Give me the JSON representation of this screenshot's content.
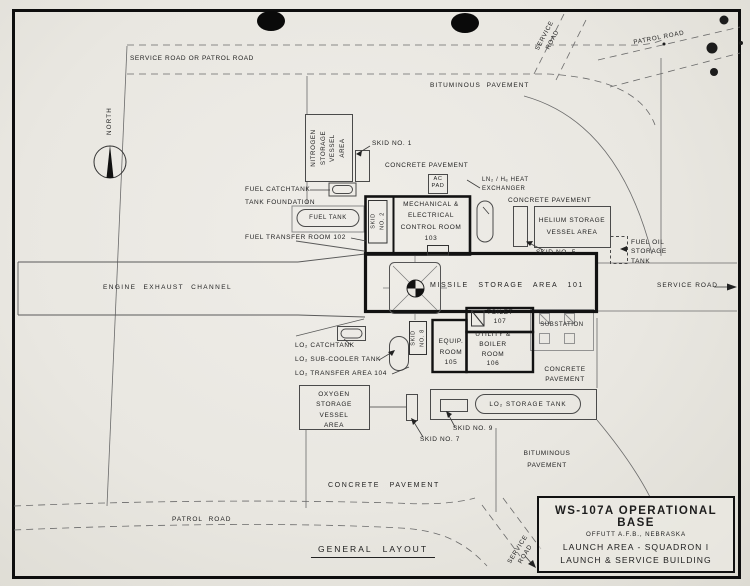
{
  "colors": {
    "paper": "#eae8e2",
    "ink": "#1d1d1d",
    "thin_line": "#5a5a5a",
    "wall": "#121212"
  },
  "title_block": {
    "l1": "WS-107A OPERATIONAL BASE",
    "l2": "OFFUTT A.F.B., NEBRASKA",
    "l3": "LAUNCH AREA - SQUADRON I",
    "l4": "LAUNCH & SERVICE BUILDING"
  },
  "caption": "GENERAL LAYOUT",
  "compass": "NORTH",
  "roads": {
    "top": "SERVICE ROAD OR PATROL ROAD",
    "service_tr": "SERVICE\nROAD",
    "patrol_tr": "PATROL ROAD",
    "service_east": "SERVICE ROAD",
    "patrol_bottom": "PATROL ROAD",
    "service_br": "SERVICE\nROAD"
  },
  "pavement": {
    "bituminous_top": "BITUMINOUS PAVEMENT",
    "bituminous_se": "BITUMINOUS\nPAVEMENT",
    "concrete_north": "CONCRETE PAVEMENT",
    "concrete_ne": "CONCRETE PAVEMENT",
    "concrete_se": "CONCRETE\nPAVEMENT",
    "concrete_south": "CONCRETE PAVEMENT"
  },
  "rooms": {
    "mech": "MECHANICAL &\nELECTRICAL\nCONTROL ROOM\n103",
    "missile": "MISSILE STORAGE AREA 101",
    "fuel_transfer": "FUEL TRANSFER ROOM 102",
    "equip": "EQUIP.\nROOM\n105",
    "utility": "UTILITY &\nBOILER\nROOM\n106",
    "toilet": "TOILET\n107",
    "exhaust_channel": "ENGINE EXHAUST CHANNEL"
  },
  "areas": {
    "nitrogen": "NITROGEN\nSTORAGE\nVESSEL\nAREA",
    "helium": "HELIUM STORAGE\nVESSEL AREA",
    "oxygen": "OXYGEN\nSTORAGE\nVESSEL\nAREA",
    "lo2_transfer": "LO₂ TRANSFER AREA 104",
    "substation": "SUBSTATION",
    "ac_pad": "AC\nPAD"
  },
  "tanks": {
    "fuel": "FUEL TANK",
    "fuel_catch": "FUEL CATCHTANK",
    "foundation": "TANK FOUNDATION",
    "fuel_oil": "FUEL OIL\nSTORAGE\nTANK",
    "lo2_catch": "LO₂ CATCHTANK",
    "lo2_sub": "LO₂ SUB-COOLER TANK",
    "lo2_storage": "LO₂ STORAGE TANK",
    "heat_exchanger": "LN₂ / Hₑ HEAT\nEXCHANGER"
  },
  "skids": {
    "n1": "SKID NO. 1",
    "n2": "SKID\nNO. 2",
    "n5": "SKID NO. 5",
    "n7": "SKID NO. 7",
    "n8": "SKID\nNO. 8",
    "n9": "SKID NO. 9"
  }
}
